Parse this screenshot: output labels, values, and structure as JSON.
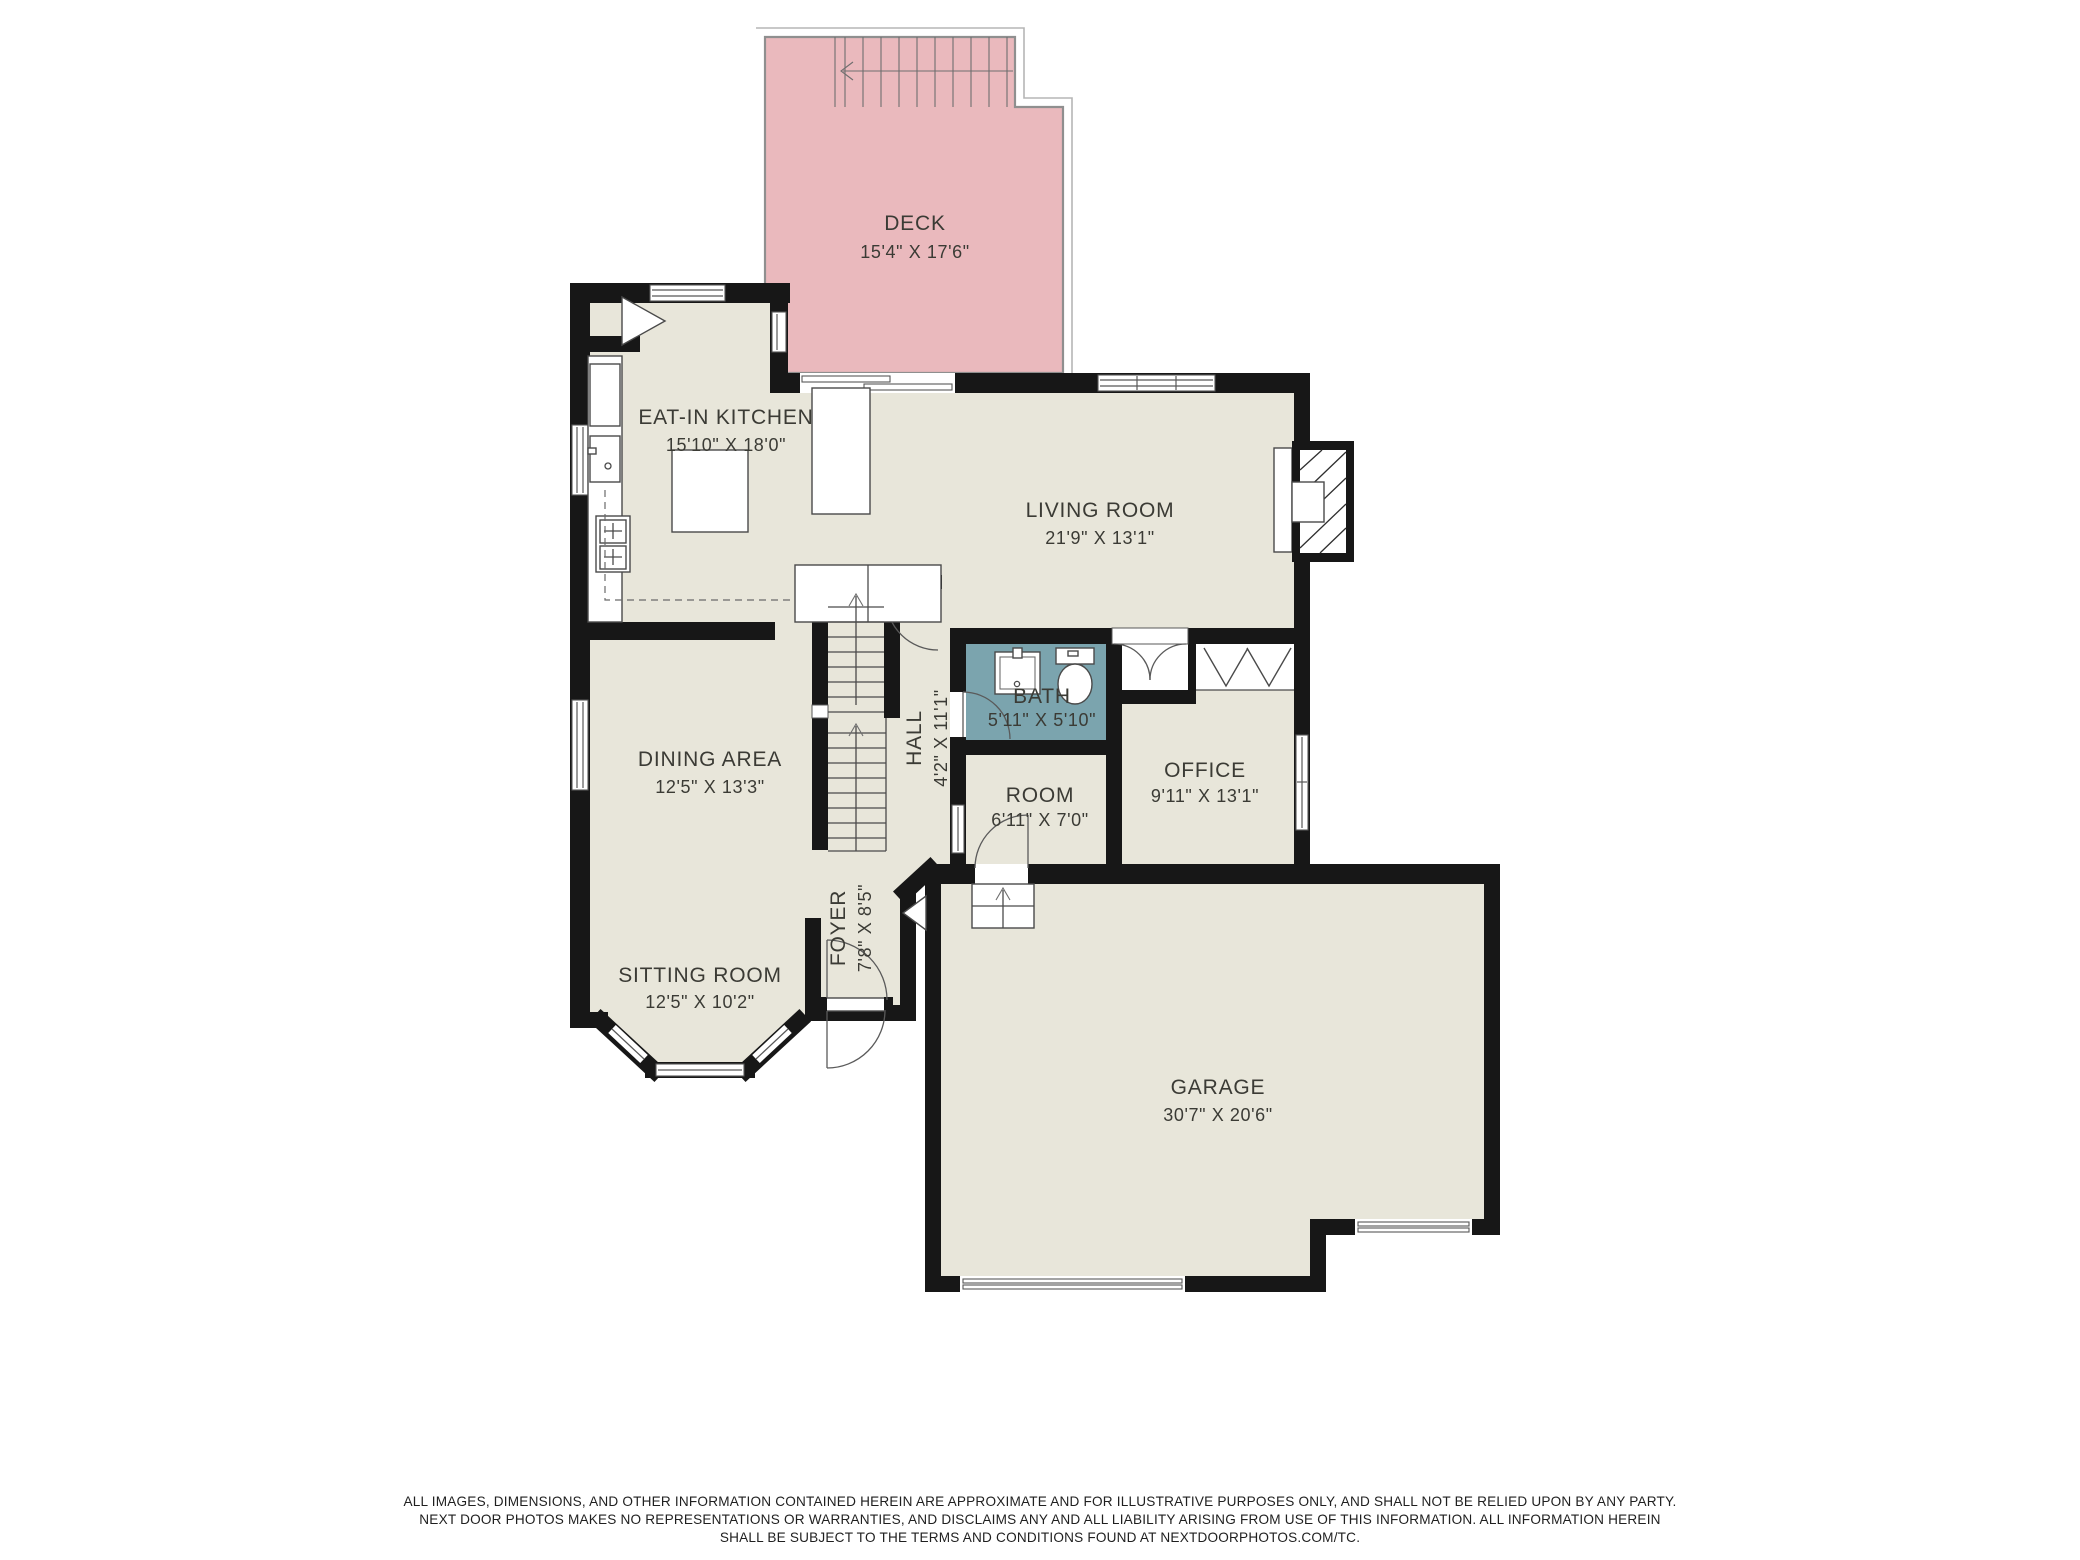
{
  "colors": {
    "background": "#ffffff",
    "floor": "#e8e6da",
    "deck": "#eab9bd",
    "bath": "#7ba4ae",
    "wall": "#171717",
    "deck_outline": "#8f8f8f",
    "label_text": "#3b3b35"
  },
  "rooms": {
    "deck": {
      "name": "DECK",
      "dims": "15'4\" X 17'6\""
    },
    "kitchen": {
      "name": "EAT-IN KITCHEN",
      "dims": "15'10\" X 18'0\""
    },
    "living": {
      "name": "LIVING ROOM",
      "dims": "21'9\" X 13'1\""
    },
    "dining": {
      "name": "DINING AREA",
      "dims": "12'5\" X 13'3\""
    },
    "sitting": {
      "name": "SITTING ROOM",
      "dims": "12'5\" X 10'2\""
    },
    "hall": {
      "name": "HALL",
      "dims": "4'2\" X 11'1\""
    },
    "foyer": {
      "name": "FOYER",
      "dims": "7'8\" X 8'5\""
    },
    "bath": {
      "name": "BATH",
      "dims": "5'11\" X 5'10\""
    },
    "room": {
      "name": "ROOM",
      "dims": "6'11\" X 7'0\""
    },
    "office": {
      "name": "OFFICE",
      "dims": "9'11\" X 13'1\""
    },
    "garage": {
      "name": "GARAGE",
      "dims": "30'7\" X 20'6\""
    }
  },
  "disclaimer": {
    "line1": "ALL IMAGES, DIMENSIONS, AND OTHER INFORMATION CONTAINED HEREIN ARE APPROXIMATE AND FOR ILLUSTRATIVE PURPOSES ONLY, AND SHALL NOT BE RELIED UPON BY ANY PARTY.",
    "line2": "NEXT DOOR PHOTOS MAKES NO REPRESENTATIONS OR WARRANTIES, AND DISCLAIMS ANY AND ALL LIABILITY ARISING FROM USE OF THIS INFORMATION. ALL INFORMATION HEREIN",
    "line3": "SHALL BE SUBJECT TO THE TERMS AND CONDITIONS FOUND AT NEXTDOORPHOTOS.COM/TC."
  }
}
